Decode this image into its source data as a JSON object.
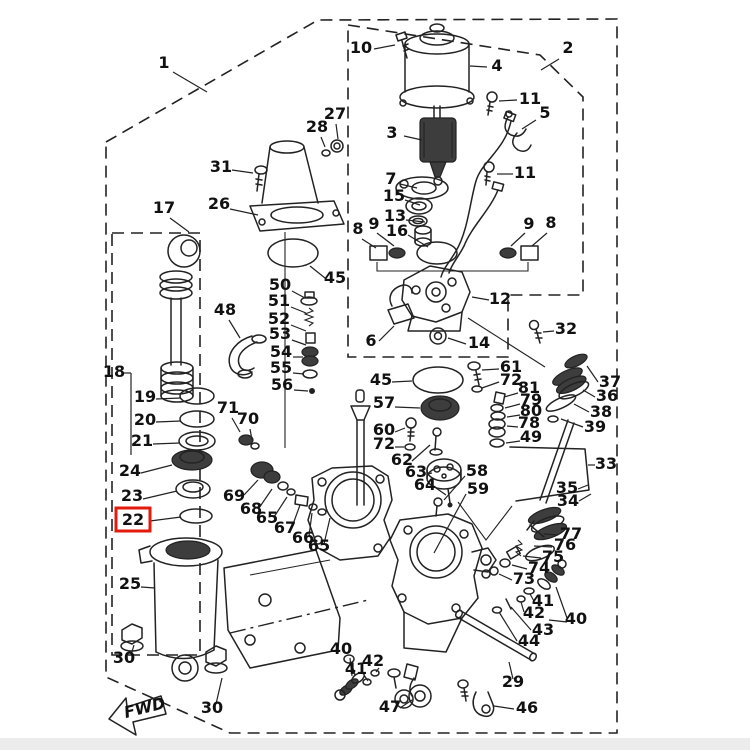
{
  "diagram": {
    "title": "Power trim and tilt exploded parts diagram",
    "fwd_label": "FWD",
    "highlighted_part": "22",
    "highlight_color": "#e31b0c",
    "line_color": "#222222",
    "labels": [
      {
        "t": "1",
        "x": 164,
        "y": 68,
        "l": [
          173,
          72,
          207,
          92
        ]
      },
      {
        "t": "2",
        "x": 568,
        "y": 53,
        "l": [
          559,
          59,
          541,
          70
        ]
      },
      {
        "t": "10",
        "x": 361,
        "y": 53,
        "l": [
          374,
          49,
          395,
          45
        ]
      },
      {
        "t": "4",
        "x": 497,
        "y": 71,
        "l": [
          487,
          67,
          470,
          66
        ]
      },
      {
        "t": "3",
        "x": 392,
        "y": 138,
        "l": [
          404,
          136,
          422,
          140
        ]
      },
      {
        "t": "11",
        "x": 530,
        "y": 104,
        "l": [
          517,
          100,
          499,
          101
        ]
      },
      {
        "t": "5",
        "x": 545,
        "y": 118,
        "l": [
          536,
          120,
          522,
          129
        ]
      },
      {
        "t": "27",
        "x": 335,
        "y": 119,
        "l": [
          336,
          124,
          338,
          139
        ]
      },
      {
        "t": "28",
        "x": 317,
        "y": 132,
        "l": [
          321,
          137,
          325,
          147
        ]
      },
      {
        "t": "31",
        "x": 221,
        "y": 172,
        "l": [
          232,
          170,
          253,
          173
        ]
      },
      {
        "t": "26",
        "x": 219,
        "y": 209,
        "l": [
          230,
          209,
          258,
          215
        ]
      },
      {
        "t": "17",
        "x": 164,
        "y": 213,
        "l": [
          170,
          218,
          189,
          232
        ]
      },
      {
        "t": "7",
        "x": 391,
        "y": 184,
        "l": [
          400,
          184,
          417,
          188
        ]
      },
      {
        "t": "15",
        "x": 394,
        "y": 201,
        "l": [
          405,
          200,
          420,
          205
        ]
      },
      {
        "t": "13",
        "x": 395,
        "y": 221,
        "l": [
          406,
          220,
          425,
          222
        ]
      },
      {
        "t": "16",
        "x": 397,
        "y": 236,
        "l": [
          408,
          235,
          428,
          247
        ]
      },
      {
        "t": "11",
        "x": 525,
        "y": 178,
        "l": [
          513,
          174,
          497,
          174
        ]
      },
      {
        "t": "8",
        "x": 358,
        "y": 234,
        "l": [
          362,
          239,
          376,
          248
        ]
      },
      {
        "t": "9",
        "x": 374,
        "y": 229,
        "l": [
          377,
          233,
          394,
          246
        ]
      },
      {
        "t": "9",
        "x": 529,
        "y": 229,
        "l": [
          525,
          233,
          511,
          246
        ]
      },
      {
        "t": "8",
        "x": 551,
        "y": 228,
        "l": [
          547,
          233,
          532,
          246
        ]
      },
      {
        "t": "45",
        "x": 335,
        "y": 283,
        "l": [
          325,
          278,
          310,
          266
        ]
      },
      {
        "t": "50",
        "x": 280,
        "y": 290,
        "l": [
          292,
          291,
          305,
          298
        ]
      },
      {
        "t": "51",
        "x": 279,
        "y": 306,
        "l": [
          291,
          307,
          306,
          313
        ]
      },
      {
        "t": "52",
        "x": 279,
        "y": 324,
        "l": [
          291,
          325,
          306,
          331
        ]
      },
      {
        "t": "53",
        "x": 280,
        "y": 339,
        "l": [
          292,
          340,
          306,
          345
        ]
      },
      {
        "t": "54",
        "x": 281,
        "y": 357,
        "l": [
          293,
          357,
          303,
          357
        ]
      },
      {
        "t": "55",
        "x": 281,
        "y": 373,
        "l": [
          293,
          373,
          304,
          374
        ]
      },
      {
        "t": "56",
        "x": 282,
        "y": 390,
        "l": [
          294,
          390,
          308,
          391
        ]
      },
      {
        "t": "48",
        "x": 225,
        "y": 315,
        "l": [
          229,
          320,
          240,
          338
        ]
      },
      {
        "t": "12",
        "x": 500,
        "y": 304,
        "l": [
          489,
          300,
          472,
          297
        ]
      },
      {
        "t": "6",
        "x": 371,
        "y": 346,
        "l": [
          379,
          341,
          394,
          326
        ]
      },
      {
        "t": "14",
        "x": 479,
        "y": 348,
        "l": [
          466,
          344,
          448,
          338
        ]
      },
      {
        "t": "32",
        "x": 566,
        "y": 334,
        "l": [
          554,
          331,
          543,
          332
        ]
      },
      {
        "t": "61",
        "x": 511,
        "y": 372,
        "l": [
          499,
          369,
          482,
          370
        ]
      },
      {
        "t": "72",
        "x": 511,
        "y": 385,
        "l": [
          499,
          382,
          482,
          388
        ]
      },
      {
        "t": "81",
        "x": 529,
        "y": 393,
        "l": [
          518,
          393,
          504,
          397
        ]
      },
      {
        "t": "79",
        "x": 531,
        "y": 405,
        "l": [
          520,
          404,
          505,
          408
        ]
      },
      {
        "t": "80",
        "x": 531,
        "y": 416,
        "l": [
          520,
          415,
          507,
          417
        ]
      },
      {
        "t": "78",
        "x": 529,
        "y": 428,
        "l": [
          518,
          427,
          507,
          426
        ]
      },
      {
        "t": "49",
        "x": 531,
        "y": 442,
        "l": [
          520,
          441,
          506,
          443
        ]
      },
      {
        "t": "45",
        "x": 381,
        "y": 385,
        "l": [
          392,
          382,
          412,
          381
        ]
      },
      {
        "t": "57",
        "x": 384,
        "y": 408,
        "l": [
          395,
          407,
          420,
          408
        ]
      },
      {
        "t": "60",
        "x": 384,
        "y": 435,
        "l": [
          395,
          432,
          405,
          428
        ]
      },
      {
        "t": "72",
        "x": 384,
        "y": 449,
        "l": [
          395,
          447,
          404,
          447
        ]
      },
      {
        "t": "62",
        "x": 402,
        "y": 465,
        "l": [
          412,
          461,
          430,
          445
        ]
      },
      {
        "t": "63",
        "x": 416,
        "y": 477,
        "l": [
          427,
          474,
          432,
          473
        ]
      },
      {
        "t": "64",
        "x": 425,
        "y": 490,
        "l": [
          436,
          488,
          446,
          495
        ]
      },
      {
        "t": "58",
        "x": 477,
        "y": 476,
        "l": [
          465,
          476,
          444,
          500
        ]
      },
      {
        "t": "59",
        "x": 478,
        "y": 494,
        "l": [
          466,
          494,
          434,
          553
        ]
      },
      {
        "t": "37",
        "x": 610,
        "y": 387,
        "l": [
          598,
          382,
          587,
          366
        ]
      },
      {
        "t": "36",
        "x": 607,
        "y": 401,
        "l": [
          595,
          397,
          583,
          390
        ]
      },
      {
        "t": "38",
        "x": 601,
        "y": 417,
        "l": [
          589,
          412,
          574,
          404
        ]
      },
      {
        "t": "39",
        "x": 595,
        "y": 432,
        "l": [
          583,
          427,
          561,
          419
        ]
      },
      {
        "t": "33",
        "x": 606,
        "y": 469,
        "l": [
          595,
          465,
          588,
          465
        ]
      },
      {
        "t": "35",
        "x": 567,
        "y": 493,
        "l": [
          578,
          489,
          588,
          485
        ]
      },
      {
        "t": "34",
        "x": 568,
        "y": 506,
        "l": [
          579,
          501,
          591,
          494
        ]
      },
      {
        "t": "77",
        "x": 571,
        "y": 539,
        "l": [
          558,
          535,
          544,
          534
        ]
      },
      {
        "t": "76",
        "x": 565,
        "y": 550,
        "l": [
          552,
          547,
          534,
          546
        ]
      },
      {
        "t": "75",
        "x": 553,
        "y": 562,
        "l": [
          541,
          558,
          523,
          556
        ]
      },
      {
        "t": "74",
        "x": 539,
        "y": 573,
        "l": [
          527,
          569,
          512,
          565
        ]
      },
      {
        "t": "73",
        "x": 524,
        "y": 584,
        "l": [
          512,
          580,
          499,
          574
        ]
      },
      {
        "t": "41",
        "x": 543,
        "y": 606,
        "l": [
          534,
          601,
          530,
          594
        ]
      },
      {
        "t": "42",
        "x": 534,
        "y": 618,
        "l": [
          524,
          612,
          521,
          602
        ]
      },
      {
        "t": "43",
        "x": 543,
        "y": 635,
        "l": [
          531,
          630,
          511,
          607
        ]
      },
      {
        "t": "44",
        "x": 529,
        "y": 646,
        "l": [
          517,
          641,
          499,
          612
        ]
      },
      {
        "t": "40",
        "x": 576,
        "y": 624,
        "l": [
          567,
          618,
          556,
          587
        ],
        "l2": [
          567,
          622,
          549,
          620
        ]
      },
      {
        "t": "29",
        "x": 513,
        "y": 687,
        "l": [
          513,
          679,
          509,
          662
        ]
      },
      {
        "t": "46",
        "x": 527,
        "y": 713,
        "l": [
          514,
          709,
          494,
          706
        ]
      },
      {
        "t": "47",
        "x": 390,
        "y": 712,
        "l": [
          400,
          708,
          412,
          700
        ]
      },
      {
        "t": "40",
        "x": 341,
        "y": 654,
        "l": [
          350,
          658,
          352,
          676
        ]
      },
      {
        "t": "41",
        "x": 356,
        "y": 674,
        "l": [
          364,
          675,
          368,
          681
        ]
      },
      {
        "t": "42",
        "x": 373,
        "y": 666,
        "l": [
          379,
          668,
          376,
          672
        ]
      },
      {
        "t": "30",
        "x": 124,
        "y": 663,
        "l": [
          131,
          655,
          134,
          645
        ]
      },
      {
        "t": "30",
        "x": 212,
        "y": 713,
        "l": [
          216,
          704,
          222,
          678
        ]
      },
      {
        "t": "25",
        "x": 130,
        "y": 589,
        "l": [
          141,
          587,
          155,
          588
        ]
      },
      {
        "t": "23",
        "x": 132,
        "y": 501,
        "l": [
          143,
          499,
          177,
          491
        ]
      },
      {
        "t": "24",
        "x": 130,
        "y": 476,
        "l": [
          141,
          473,
          172,
          465
        ]
      },
      {
        "t": "22",
        "x": 133,
        "y": 525,
        "hl": true,
        "l": [
          150,
          521,
          181,
          517
        ]
      },
      {
        "t": "21",
        "x": 142,
        "y": 446,
        "l": [
          153,
          444,
          180,
          443
        ]
      },
      {
        "t": "20",
        "x": 145,
        "y": 425,
        "l": [
          156,
          422,
          181,
          421
        ]
      },
      {
        "t": "19",
        "x": 145,
        "y": 402,
        "l": [
          156,
          399,
          181,
          398
        ]
      },
      {
        "t": "18",
        "x": 114,
        "y": 377,
        "l": [
          123,
          373,
          131,
          373
        ],
        "l2": [
          131,
          373,
          131,
          455
        ]
      },
      {
        "t": "71",
        "x": 228,
        "y": 413,
        "l": [
          232,
          418,
          240,
          432
        ]
      },
      {
        "t": "70",
        "x": 248,
        "y": 424,
        "l": [
          250,
          429,
          252,
          440
        ]
      },
      {
        "t": "69",
        "x": 234,
        "y": 501,
        "l": [
          244,
          495,
          258,
          480
        ]
      },
      {
        "t": "68",
        "x": 251,
        "y": 514,
        "l": [
          259,
          508,
          272,
          489
        ]
      },
      {
        "t": "65",
        "x": 267,
        "y": 523,
        "l": [
          274,
          517,
          287,
          497
        ]
      },
      {
        "t": "67",
        "x": 285,
        "y": 533,
        "l": [
          292,
          527,
          300,
          505
        ]
      },
      {
        "t": "66",
        "x": 303,
        "y": 543,
        "l": [
          309,
          536,
          312,
          513
        ]
      },
      {
        "t": "65",
        "x": 319,
        "y": 551,
        "l": [
          324,
          544,
          330,
          518
        ]
      }
    ]
  }
}
